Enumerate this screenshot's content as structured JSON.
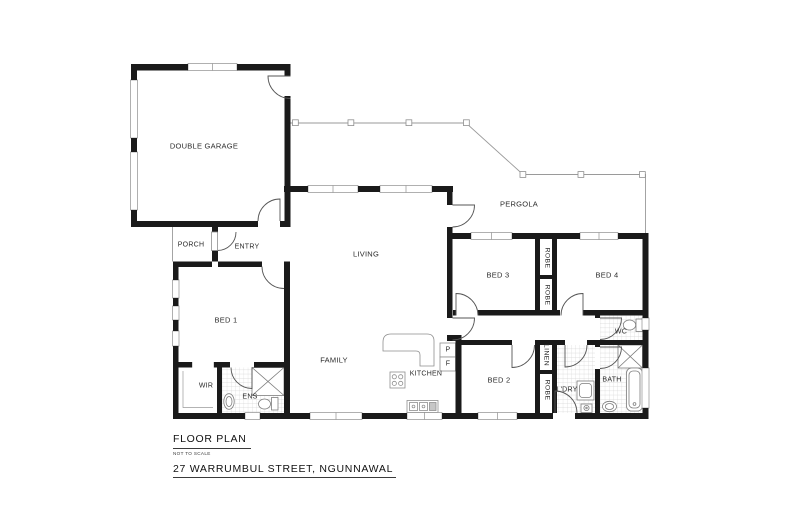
{
  "footer": {
    "title": "FLOOR PLAN",
    "scale_note": "NOT TO SCALE",
    "address": "27 WARRUMBUL STREET, NGUNNAWAL"
  },
  "rooms": {
    "double_garage": {
      "label": "DOUBLE GARAGE"
    },
    "porch": {
      "label": "PORCH"
    },
    "entry": {
      "label": "ENTRY"
    },
    "living": {
      "label": "LIVING"
    },
    "pergola": {
      "label": "PERGOLA"
    },
    "family": {
      "label": "FAMILY"
    },
    "kitchen": {
      "label": "KITCHEN"
    },
    "pantry": {
      "label": "P"
    },
    "fridge": {
      "label": "F"
    },
    "bed1": {
      "label": "BED 1"
    },
    "bed2": {
      "label": "BED 2"
    },
    "bed3": {
      "label": "BED 3"
    },
    "bed4": {
      "label": "BED 4"
    },
    "wir": {
      "label": "WIR"
    },
    "ens": {
      "label": "ENS"
    },
    "wc": {
      "label": "WC"
    },
    "bath": {
      "label": "BATH"
    },
    "laundry": {
      "label": "L'DRY"
    },
    "linen": {
      "label": "LINEN"
    },
    "robe_bed3": {
      "label": "ROBE"
    },
    "robe_bed4": {
      "label": "ROBE"
    },
    "robe_bed2": {
      "label": "ROBE"
    }
  },
  "colors": {
    "wall": "#1a1a1a",
    "thin_line": "#8f8f8f",
    "tile_line": "#d4d4d4",
    "text": "#2b2b2b"
  }
}
